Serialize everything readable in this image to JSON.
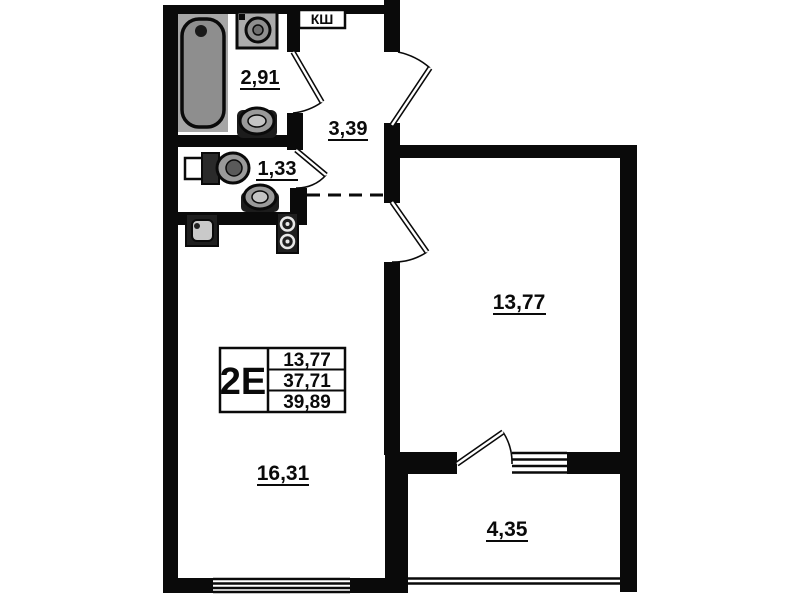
{
  "unit": {
    "type_label": "2Е",
    "values": [
      "13,77",
      "37,71",
      "39,89"
    ]
  },
  "labels": {
    "kitchen_cabinet": "КШ"
  },
  "rooms": {
    "bathroom": {
      "area": "2,91"
    },
    "hallway": {
      "area": "3,39"
    },
    "toilet": {
      "area": "1,33"
    },
    "bedroom": {
      "area": "13,77"
    },
    "living_kitchen": {
      "area": "16,31"
    },
    "balcony": {
      "area": "4,35"
    }
  },
  "colors": {
    "wall": "#000000",
    "fixture_gray": "#a6a6a6",
    "background": "#ffffff"
  }
}
